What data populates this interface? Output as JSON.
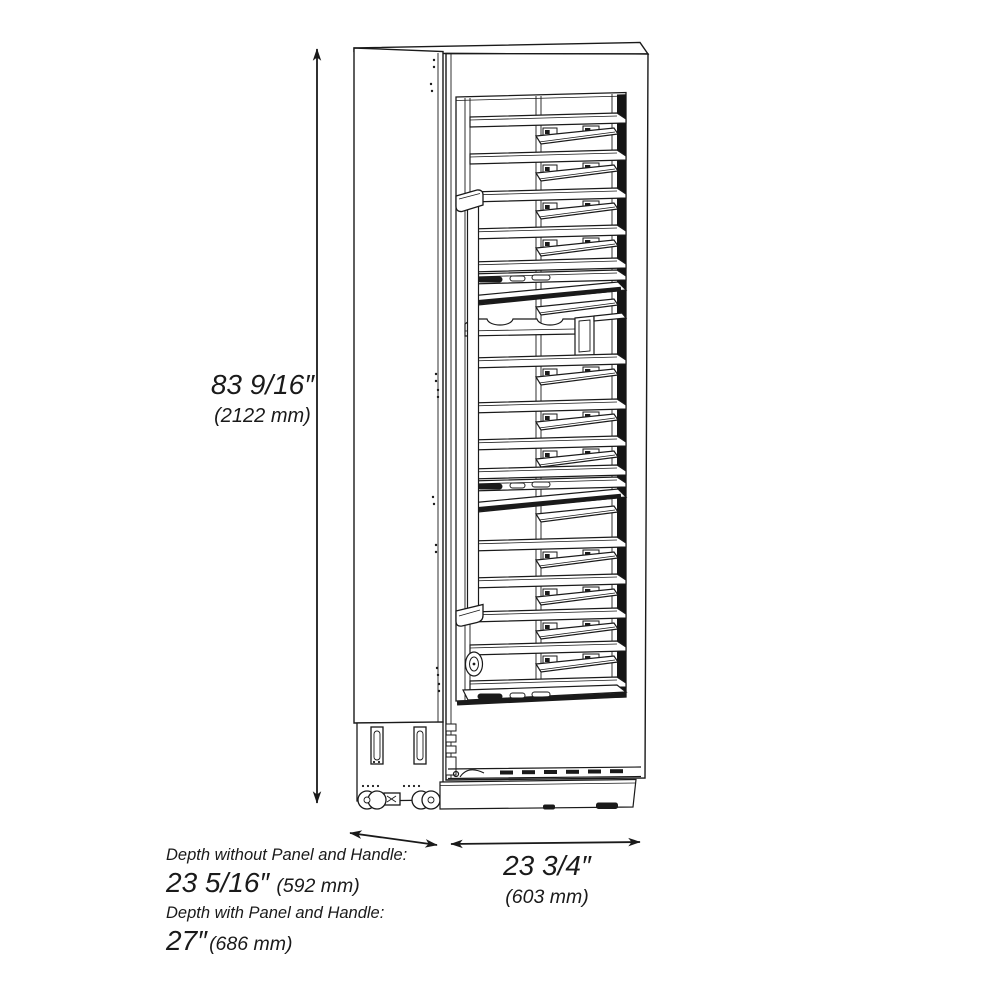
{
  "dimensions": {
    "height": {
      "inches": "83 9/16″",
      "mm": "(2122 mm)"
    },
    "width": {
      "inches": "23 3/4″",
      "mm": "(603 mm)"
    },
    "depth_without": {
      "label": "Depth without Panel and Handle:",
      "inches": "23 5/16″",
      "mm": "(592 mm)"
    },
    "depth_with": {
      "label": "Depth with Panel and Handle:",
      "inches": "27″",
      "mm": "(686 mm)"
    }
  },
  "figure": {
    "subject": "tall column wine cooler with glass door, technical line drawing, three-quarter side view",
    "colors": {
      "line": "#1a1a1a",
      "background": "#ffffff",
      "glass_side_band": "#151515"
    },
    "shelf_rows": [
      {
        "y": 117,
        "type": "shelf_tray"
      },
      {
        "y": 154,
        "type": "shelf_tray"
      },
      {
        "y": 192,
        "type": "shelf_tray"
      },
      {
        "y": 229,
        "type": "shelf_tray"
      },
      {
        "y": 262,
        "type": "shelf_plain"
      },
      {
        "y": 274,
        "type": "shelf_items"
      },
      {
        "y": 286,
        "type": "display"
      },
      {
        "y": 318,
        "type": "wavy"
      },
      {
        "y": 358,
        "type": "shelf_tray"
      },
      {
        "y": 403,
        "type": "shelf_tray"
      },
      {
        "y": 440,
        "type": "shelf_tray"
      },
      {
        "y": 469,
        "type": "shelf_plain"
      },
      {
        "y": 481,
        "type": "shelf_items"
      },
      {
        "y": 493,
        "type": "display"
      },
      {
        "y": 541,
        "type": "shelf_tray"
      },
      {
        "y": 578,
        "type": "shelf_tray"
      },
      {
        "y": 612,
        "type": "shelf_tray"
      },
      {
        "y": 645,
        "type": "shelf_tray"
      },
      {
        "y": 681,
        "type": "shelf_plain"
      },
      {
        "y": 690,
        "type": "sill"
      }
    ]
  }
}
